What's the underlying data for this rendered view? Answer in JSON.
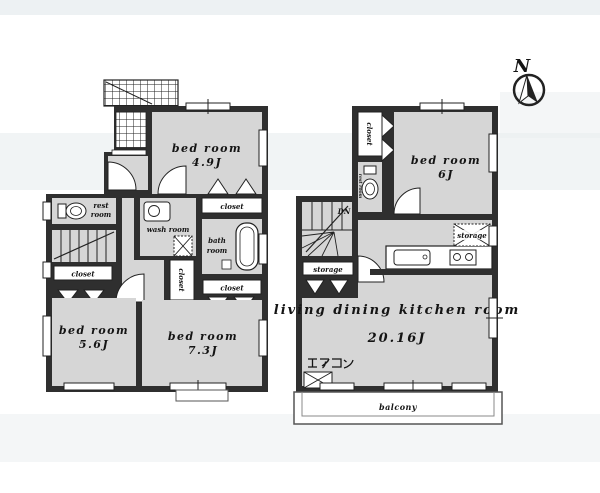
{
  "compass": {
    "north": "N"
  },
  "floor1": {
    "bedroom_49": {
      "name": "bed room",
      "size": "4.9J"
    },
    "restroom": {
      "line1": "rest",
      "line2": "room"
    },
    "stairs_label": "UP",
    "washroom": {
      "name": "wash room"
    },
    "bathroom": {
      "line1": "bath",
      "line2": "room"
    },
    "closet_bedroom49": "closet",
    "closet_hall_left": "closet",
    "closet_hall_mid": "closet",
    "closet_bedroom73": "closet",
    "bedroom_56": {
      "name": "bed room",
      "size": "5.6J"
    },
    "bedroom_73": {
      "name": "bed room",
      "size": "7.3J"
    }
  },
  "floor2": {
    "closet_bedroom6": "closet",
    "bedroom_6": {
      "name": "bed room",
      "size": "6J"
    },
    "restroom_label": "rest room",
    "stairs_label": "DN",
    "storage_under_stairs": "storage",
    "storage_kitchen": "storage",
    "ldk": {
      "name": "living dining kitchen room",
      "size": "20.16J"
    },
    "aircon_label": "エアコン",
    "balcony_label": "balcony"
  },
  "colors": {
    "wall": "#2f2f2f",
    "room_fill": "#d6d6d6",
    "background_band": "#e9eef0",
    "line": "#1a1a1a",
    "paper": "#ffffff"
  }
}
